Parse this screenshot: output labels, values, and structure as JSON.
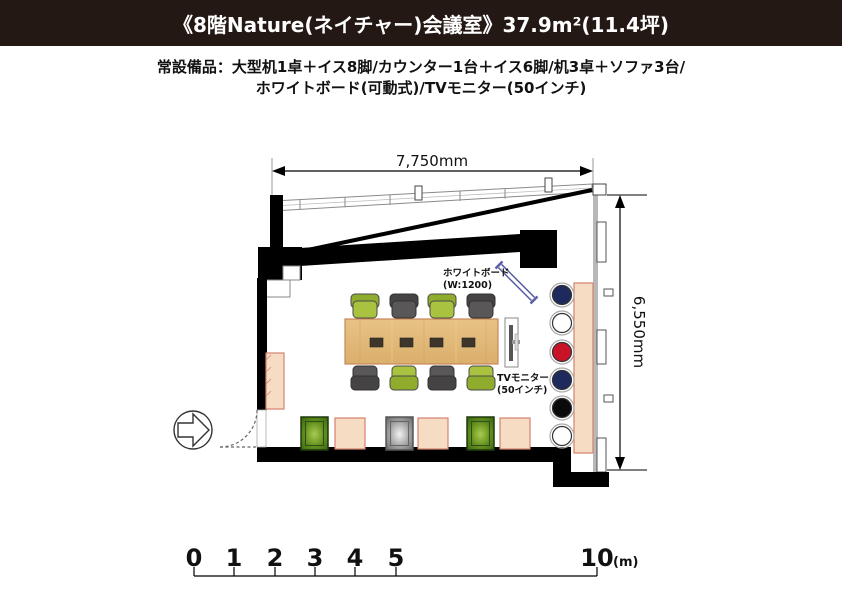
{
  "header": {
    "title": "《8階Nature(ネイチャー)会議室》37.9m²(11.4坪)",
    "bg_color": "#231814",
    "fg_color": "#ffffff"
  },
  "equipment": {
    "line1": "常設備品：大型机1卓＋イス8脚/カウンター1台＋イス6脚/机3卓＋ソファ3台/",
    "line2": "ホワイトボード(可動式)/TVモニター(50インチ)"
  },
  "plan": {
    "width_dim": "7,750mm",
    "height_dim": "6,550mm",
    "whiteboard_label": [
      "ホワイトボード",
      "(W:1200)"
    ],
    "tv_label": [
      "TVモニター",
      "(50インチ)"
    ],
    "stools": [
      {
        "color": "#1E2A5E"
      },
      {
        "color": "#FFFFFF"
      },
      {
        "color": "#C91428"
      },
      {
        "color": "#1E2A5E"
      },
      {
        "color": "#0A0A0A"
      },
      {
        "color": "#FFFFFF"
      }
    ],
    "colors": {
      "wall": "#000000",
      "window_frame": "#B8B8B8",
      "chair_green": "#A9C23F",
      "chair_green_back": "#8FAC2C",
      "chair_gray": "#595757",
      "chair_gray_back": "#454343",
      "table_wood": "#E3BB7B",
      "outlet": "#3E352B",
      "counter": "#F7DCC4",
      "counter_border": "#D4836F",
      "whiteboard_accent": "#5B5EA6"
    }
  },
  "scale_bar": {
    "ticks": [
      "0",
      "1",
      "2",
      "3",
      "4",
      "5"
    ],
    "end": "10",
    "unit": "(m)"
  }
}
